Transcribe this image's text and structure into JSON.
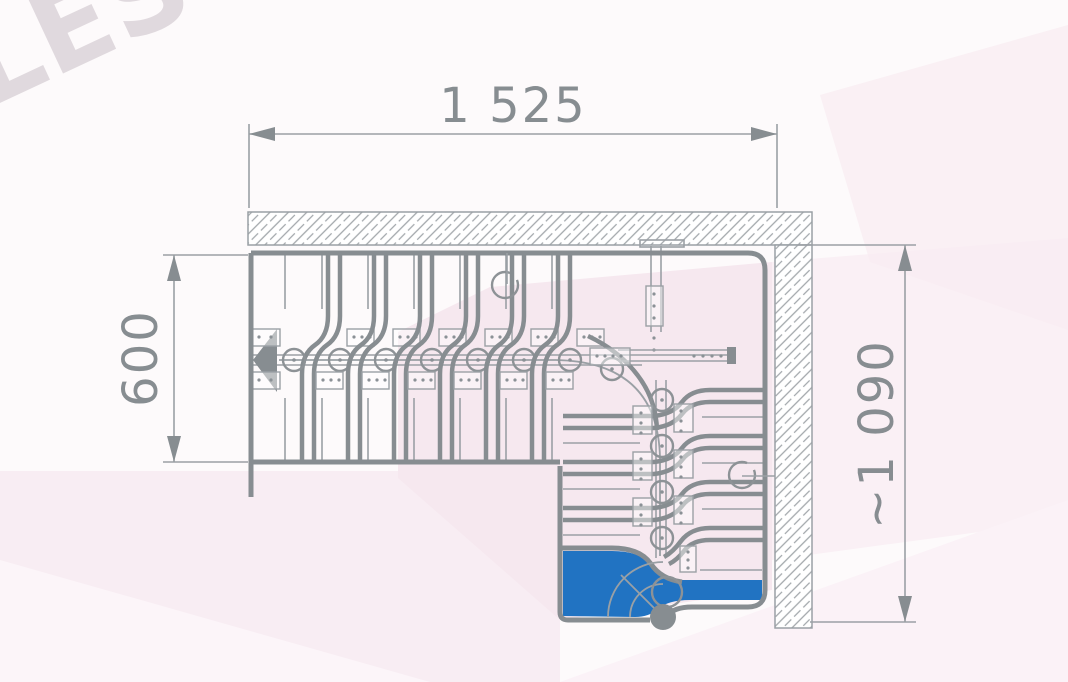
{
  "watermark": {
    "text": "LESTNICYPROSTO.RU"
  },
  "dimensions": {
    "top_width": "1 525",
    "left_flight_width": "600",
    "right_depth": "~1 090"
  },
  "colors": {
    "line_gray": "#878d91",
    "thin_gray": "#9ba0a5",
    "accent_blue": "#2173c2",
    "wall_hatch": "#a2a7ab",
    "background": "#fdfafb",
    "pink_tint": "#f6e8ef",
    "watermark_gray": "#b7abb4"
  }
}
